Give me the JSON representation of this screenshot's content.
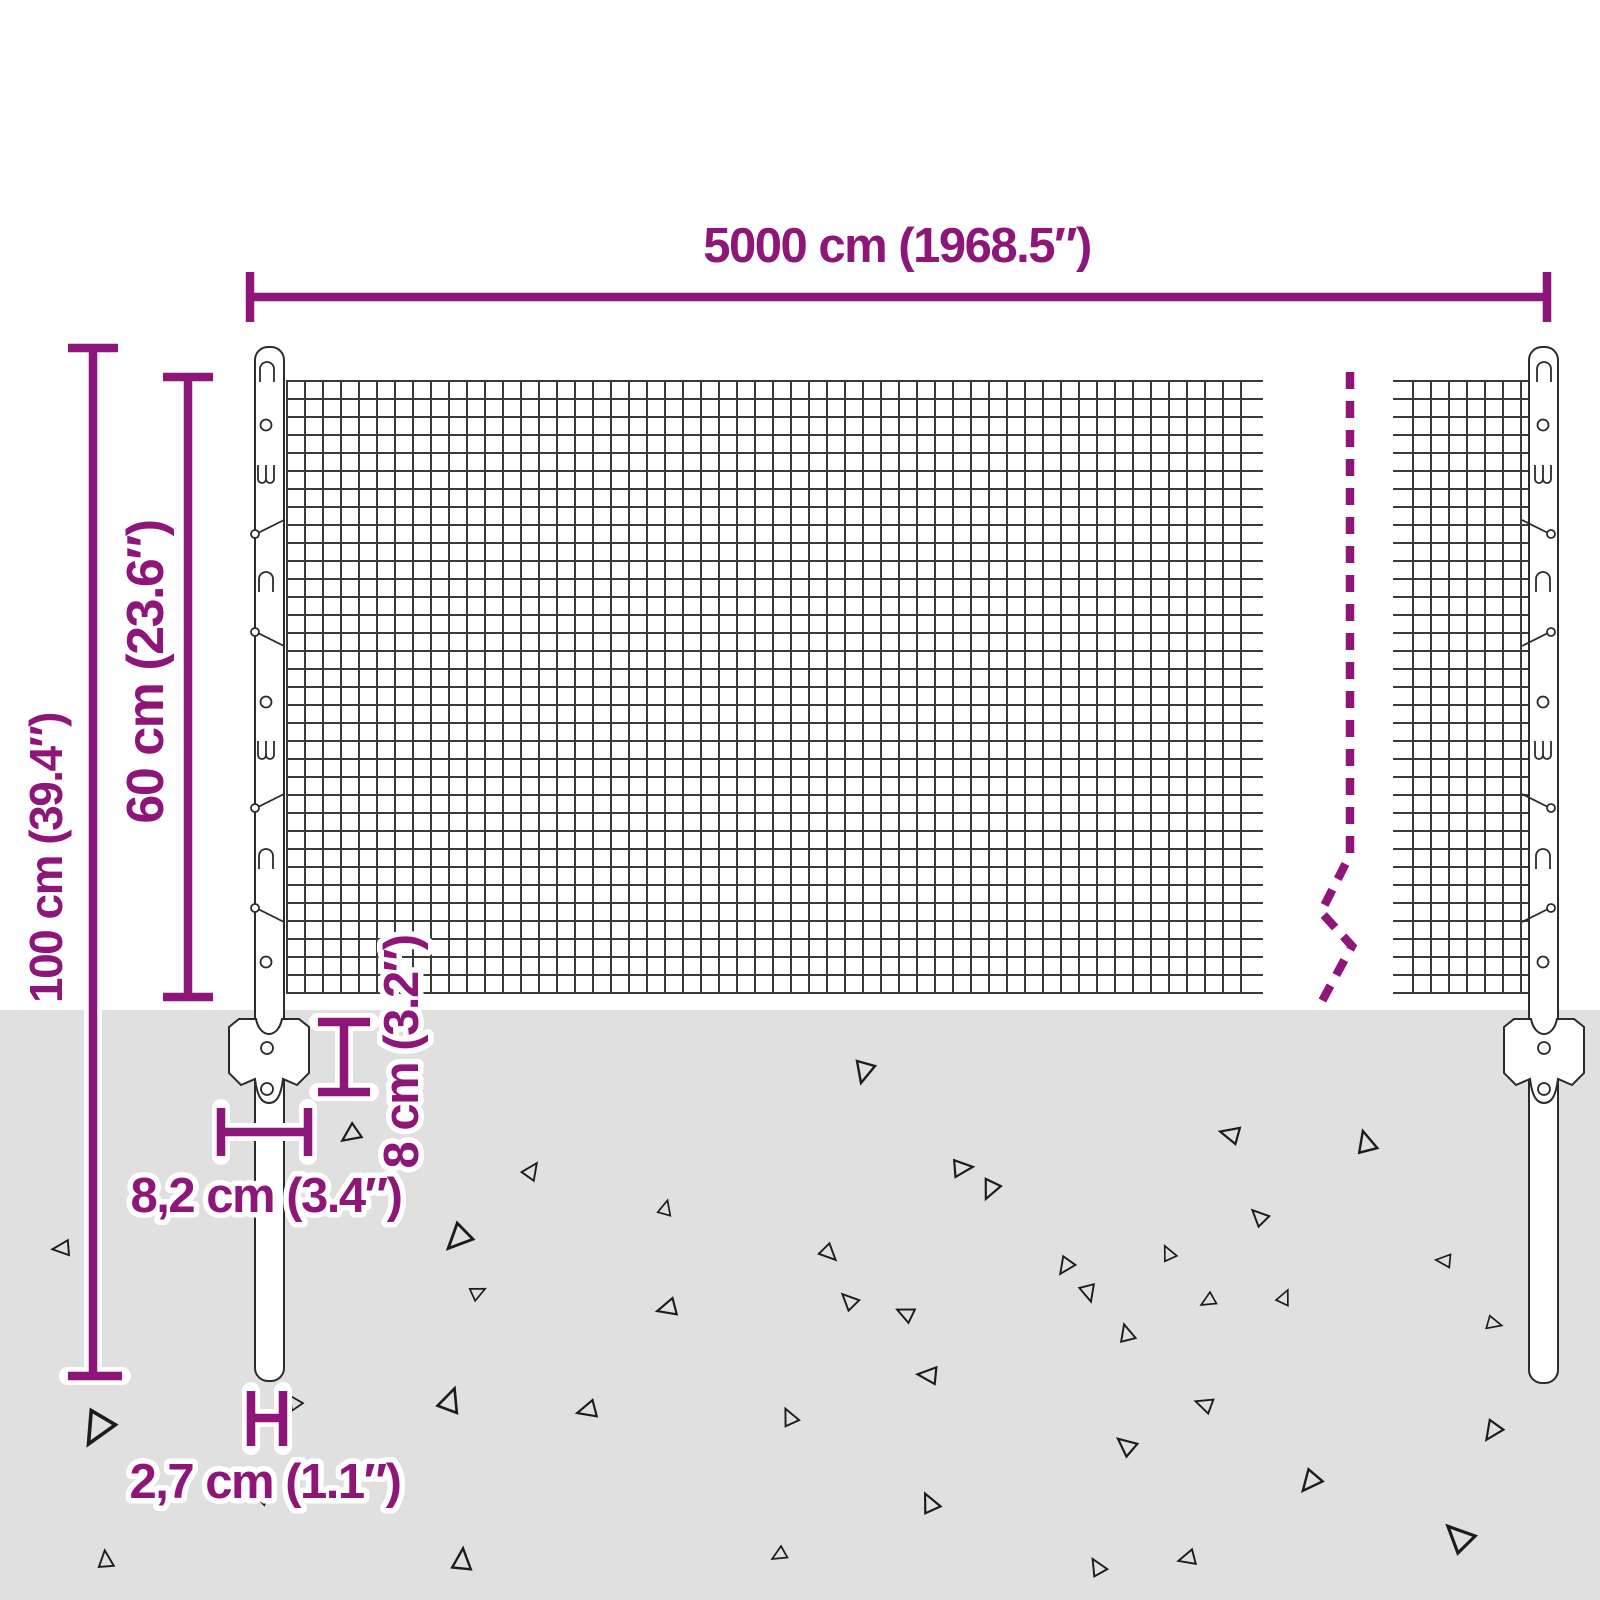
{
  "diagram": {
    "type": "product-dimension-diagram",
    "subject": "wire mesh fence panel with posts and anchor plates",
    "labels": {
      "fence_length": "5000 cm (1968.5″)",
      "post_height": "100 cm (39.4″)",
      "mesh_height": "60 cm (23.6″)",
      "anchor_plate_height": "8 cm (3.2″)",
      "anchor_plate_width": "8,2 cm (3.4″)",
      "post_diameter": "2,7 cm (1.1″)"
    },
    "colors": {
      "accent": "#8d1678",
      "ground": "#e0e0e0",
      "mesh_line": "#3a3a3a",
      "outline": "#2b2b2b",
      "background": "#ffffff"
    }
  }
}
